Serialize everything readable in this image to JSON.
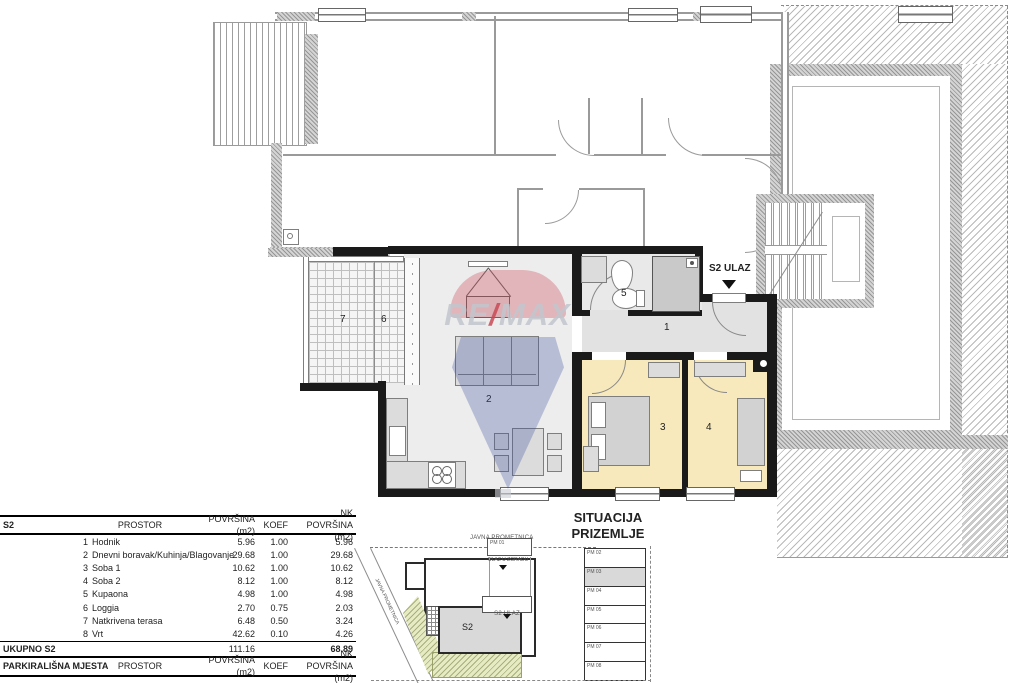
{
  "floor_plan": {
    "entrance_label": "S2 ULAZ",
    "rooms": {
      "hall": "1",
      "living": "2",
      "bedroom1": "3",
      "bedroom2": "4",
      "bathroom": "5",
      "loggia": "6",
      "terrace": "7"
    }
  },
  "watermark": {
    "re": "RE",
    "slash": "/",
    "max": "MAX"
  },
  "area_table": {
    "header": {
      "unit": "S2",
      "room": "PROSTOR",
      "area": "POVRŠINA (m2)",
      "koef": "KOEF",
      "nk": "NK POVRŠINA (m2)"
    },
    "rows": [
      {
        "n": "1",
        "name": "Hodnik",
        "area": "5.96",
        "koef": "1.00",
        "nk": "5.96"
      },
      {
        "n": "2",
        "name": "Dnevni boravak/Kuhinja/Blagovanje",
        "area": "29.68",
        "koef": "1.00",
        "nk": "29.68"
      },
      {
        "n": "3",
        "name": "Soba 1",
        "area": "10.62",
        "koef": "1.00",
        "nk": "10.62"
      },
      {
        "n": "4",
        "name": "Soba 2",
        "area": "8.12",
        "koef": "1.00",
        "nk": "8.12"
      },
      {
        "n": "5",
        "name": "Kupaona",
        "area": "4.98",
        "koef": "1.00",
        "nk": "4.98"
      },
      {
        "n": "6",
        "name": "Loggia",
        "area": "2.70",
        "koef": "0.75",
        "nk": "2.03"
      },
      {
        "n": "7",
        "name": "Natkrivena terasa",
        "area": "6.48",
        "koef": "0.50",
        "nk": "3.24"
      },
      {
        "n": "8",
        "name": "Vrt",
        "area": "42.62",
        "koef": "0.10",
        "nk": "4.26"
      }
    ],
    "total": {
      "label": "UKUPNO S2",
      "area": "111.16",
      "nk": "68.89"
    },
    "parking_header": {
      "unit": "PARKIRALIŠNA MJESTA",
      "room": "PROSTOR",
      "area": "POVRŠINA (m2)",
      "koef": "KOEF",
      "nk": "NK POVRŠINA (m2)"
    }
  },
  "site_plan": {
    "title1": "SITUACIJA",
    "title2": "PRIZEMLJE",
    "road_top": "JAVNA PROMETNICA",
    "road_left": "JAVNA PROMETNICA",
    "building_entrance": "ULAZ U ZGRADU",
    "unit_entrance": "S2 ULAZ",
    "unit": "S2",
    "parking_box": "PM 01",
    "stalls": [
      "PM 02",
      "PM 03",
      "PM 04",
      "PM 05",
      "PM 06",
      "PM 07",
      "PM 08"
    ]
  }
}
